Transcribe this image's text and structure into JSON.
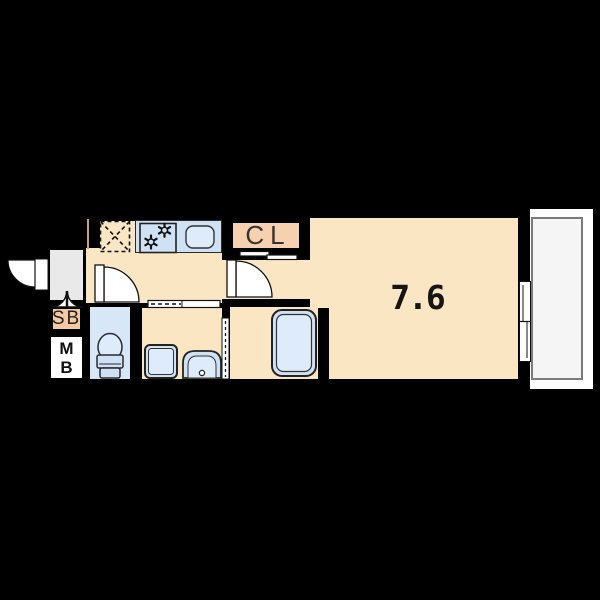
{
  "floor_plan": {
    "main_room": {
      "size_label": "7.6"
    },
    "closet": {
      "label": "CL"
    },
    "shoe_box": {
      "label": "SB"
    },
    "meter_box": {
      "line1": "M",
      "line2": "B"
    },
    "icons": [
      "refrigerator-space-icon",
      "gas-stove-icon",
      "kitchen-sink-icon",
      "door-swing-icon",
      "double-door-icon",
      "sliding-door-icon",
      "folding-door-icon",
      "toilet-icon",
      "washing-machine-icon",
      "wash-basin-icon",
      "bathtub-icon",
      "sliding-window-icon"
    ],
    "colors": {
      "bg": "#000000",
      "floor": "#fbe6c3",
      "porch": "#e9e9e9",
      "closet-fill": "#f7d1af",
      "shoebox-fill": "#f5c9a4",
      "blue": "#cfe1f5",
      "blue-light": "#ddebfa",
      "toilet-floor": "#d8e7f8",
      "balcony-fill": "#f5f5f5",
      "balcony-border": "#7b7b7b",
      "white": "#ffffff"
    }
  }
}
